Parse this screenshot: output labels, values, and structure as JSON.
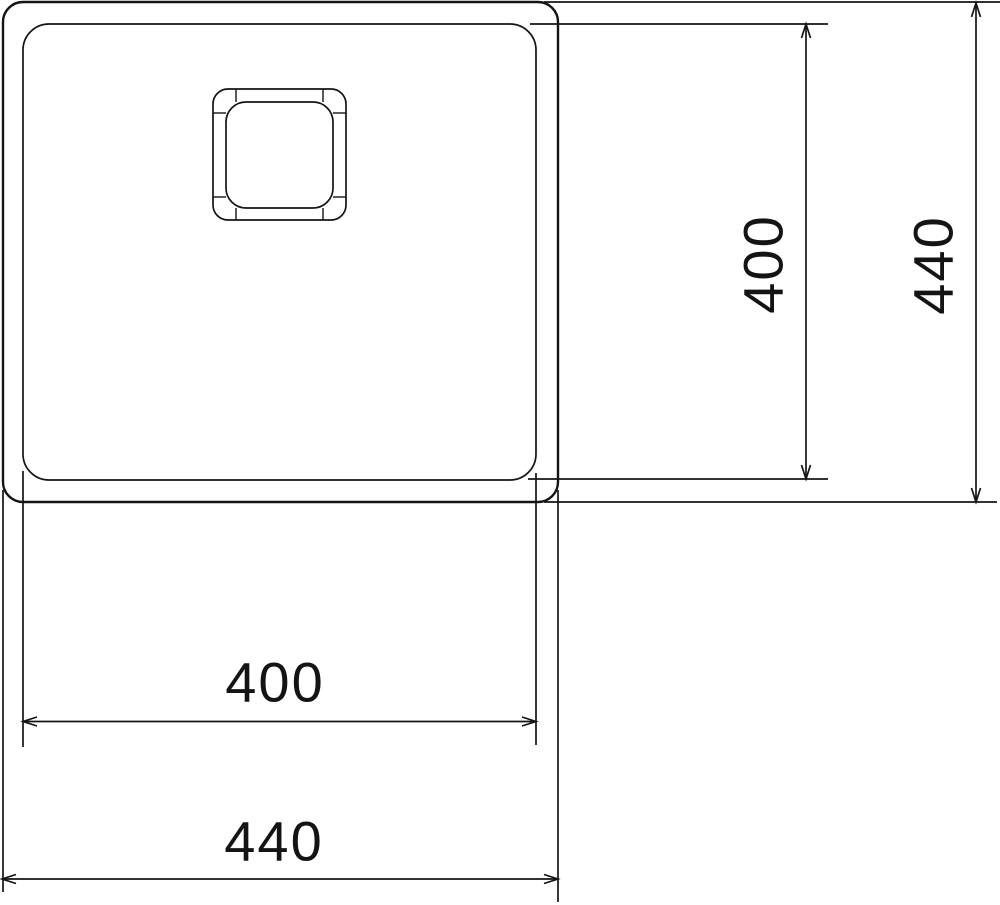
{
  "diagram": {
    "background": "#ffffff",
    "stroke_color": "#141414",
    "text_color": "#141414",
    "labels": {
      "bowl_width": "400",
      "overall_width": "440",
      "bowl_depth": "400",
      "overall_depth": "440"
    }
  }
}
